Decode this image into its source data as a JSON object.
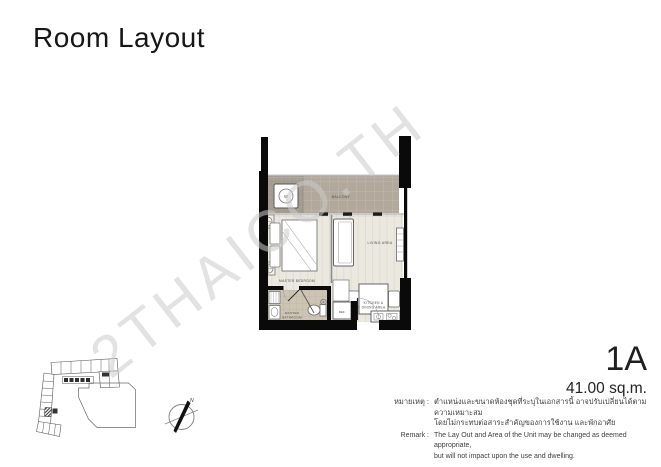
{
  "header": {
    "title": "Room Layout"
  },
  "watermark": {
    "text": "2THAICO.TH"
  },
  "unit": {
    "code": "1A",
    "area": "41.00 sq.m."
  },
  "floor_plan": {
    "labels": {
      "balcony": "BALCONY",
      "master_bedroom": "MASTER BEDROOM",
      "living_area": "LIVING AREA",
      "kitchen_line1": "KITCHEN &",
      "kitchen_line2": "DINING AREA",
      "bathroom_line1": "MASTER",
      "bathroom_line2": "BATHROOM",
      "fridge": "REF.",
      "washer": "W"
    }
  },
  "compass": {
    "north": "N"
  },
  "remark": {
    "thai_label": "หมายเหตุ :",
    "thai_line1": "ตำแหน่งและขนาดห้องชุดที่ระบุในเอกสารนี้ อาจปรับเปลี่ยนได้ตามความเหมาะสม",
    "thai_line2": "โดยไม่กระทบต่อสาระสำคัญของการใช้งาน และพักอาศัย",
    "en_label": "Remark :",
    "en_line1": "The Lay Out and Area of the Unit may be changed as deemed appropriate,",
    "en_line2": "but will not impact upon the use and dwelling."
  },
  "colors": {
    "wall": "#0a0a0a",
    "balcony_tile": "#b2a99c",
    "washer_zone_tile": "#a49c90",
    "wood_floor": "#ebe8e0",
    "bathroom_tile": "#cdc4b4",
    "label_text": "#4d4d4d",
    "watermark_gray": "#cbcbcb"
  }
}
